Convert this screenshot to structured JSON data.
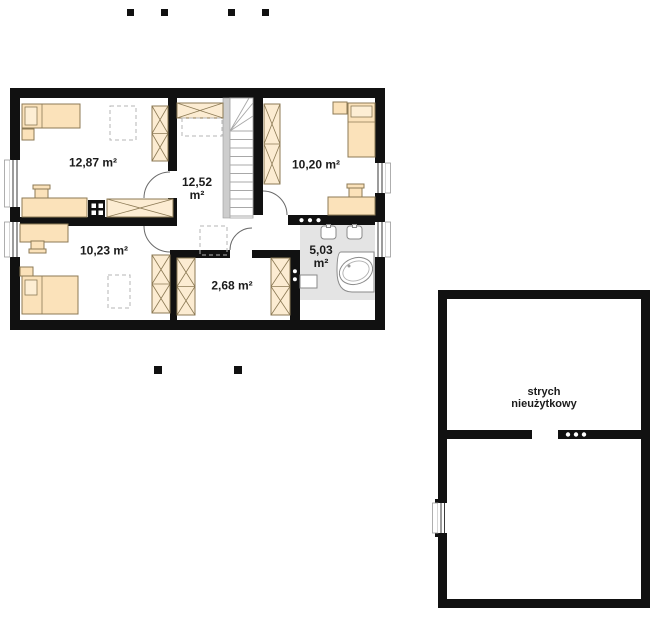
{
  "rooms": {
    "bedroom_top_left": {
      "area": "12,87 m²"
    },
    "hall": {
      "area_value": "12,52",
      "area_unit": "m²"
    },
    "bedroom_top_right": {
      "area": "10,20 m²"
    },
    "bedroom_bottom_left": {
      "area": "10,23 m²"
    },
    "closet": {
      "area": "2,68 m²"
    },
    "bathroom": {
      "area_value": "5,03",
      "area_unit": "m²"
    },
    "attic": {
      "label_line1": "strych",
      "label_line2": "nieużytkowy"
    }
  },
  "colors": {
    "background": "#ffffff",
    "wall": "#111111",
    "furniture": "#fbe2ba",
    "furniture_light": "#fcecd2",
    "furniture_stroke": "#8c7a55",
    "bath_floor": "#e4e4e4",
    "dash": "#b5b5b5",
    "fixture_stroke": "#8a8a8a",
    "text": "#1b1b1b"
  }
}
